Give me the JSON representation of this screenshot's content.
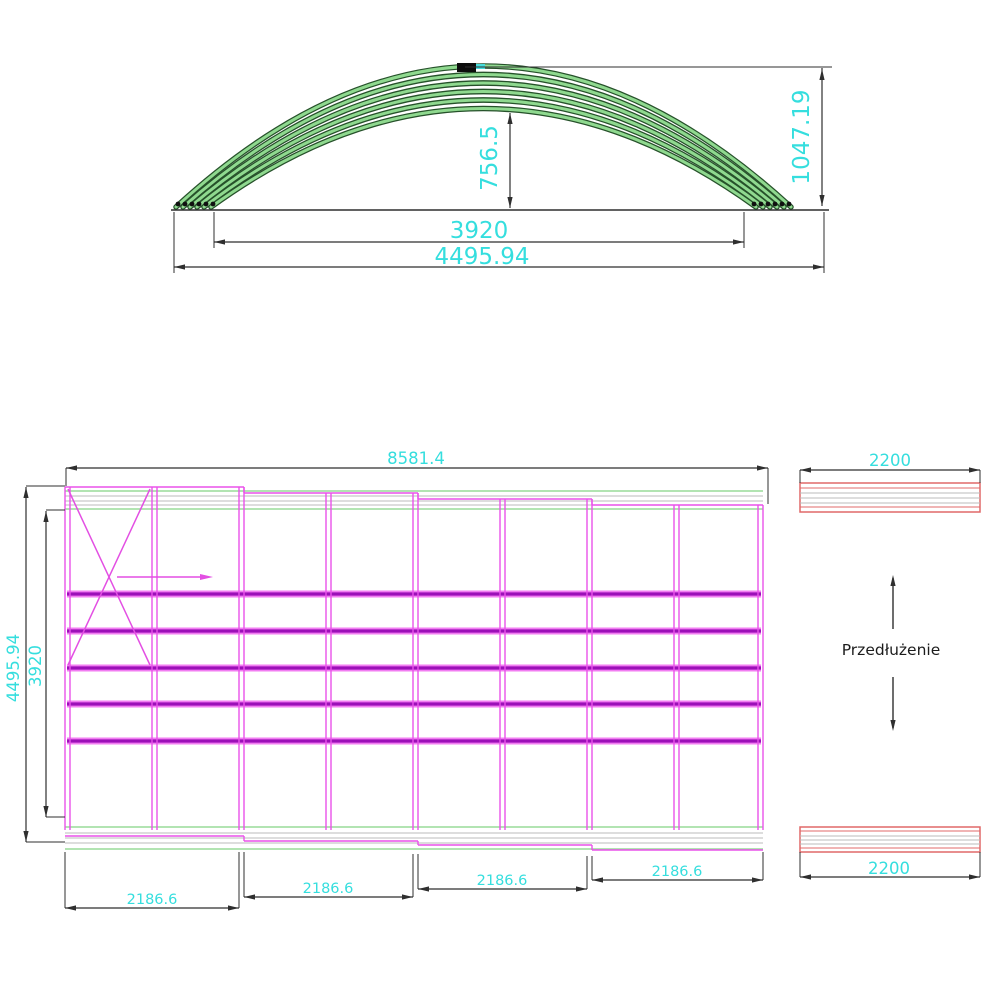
{
  "drawing": {
    "front_view": {
      "dim_inner_height": "756.5",
      "dim_total_height": "1047.19",
      "dim_inner_span": "3920",
      "dim_outer_span": "4495.94"
    },
    "plan_view": {
      "dim_total_width": "8581.4",
      "dim_outer_depth": "4495.94",
      "dim_inner_depth": "3920",
      "module_dims": [
        "2186.6",
        "2186.6",
        "2186.6",
        "2186.6"
      ]
    },
    "extension": {
      "label": "Przedłużenie",
      "dim_top": "2200",
      "dim_bottom": "2200"
    },
    "colors": {
      "dimension_text": "#35dede",
      "dimension_line": "#2f2f2f",
      "structure_magenta": "#ea52ea",
      "rail_purple": "#9c10b8",
      "arch_green": "#8fd98f",
      "arch_outline": "#26512a",
      "extension_red": "#e06868",
      "guide_green": "#98db98"
    }
  }
}
